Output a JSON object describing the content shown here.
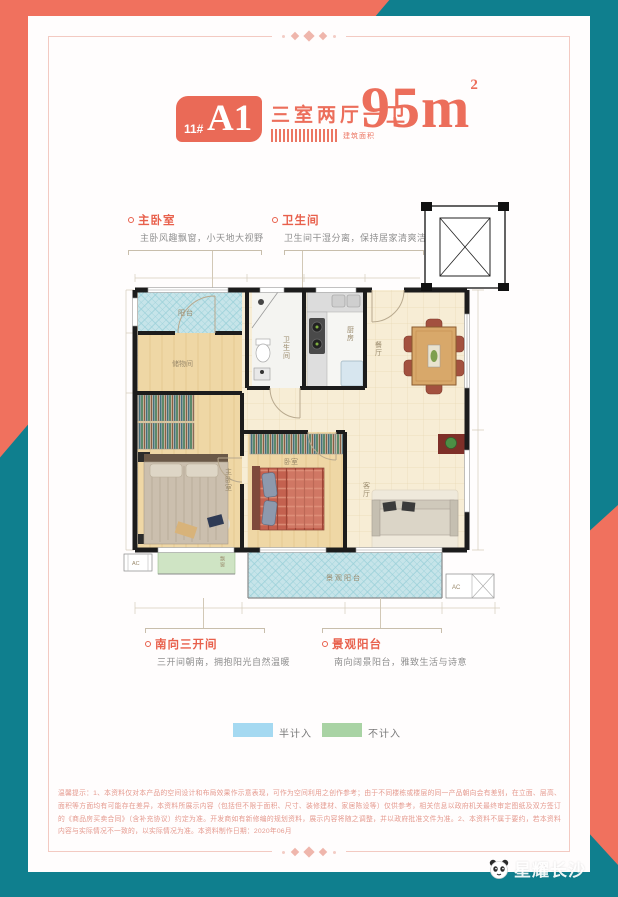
{
  "header": {
    "block_no": "11#",
    "unit": "A1",
    "layout": "三室两厅一卫",
    "area_label": "建筑面积",
    "area_value": "95",
    "area_unit": "m",
    "area_sup": "2"
  },
  "colors": {
    "teal": "#0f7f8e",
    "coral": "#f0715e",
    "badge": "#ea6a57",
    "legend_blue": "#a5d9f1",
    "legend_green": "#a9d3a4"
  },
  "plan": {
    "rooms": {
      "balcony": "阳台",
      "storage": "储物间",
      "bath": "卫生间",
      "kitchen": "厨房",
      "dining": "餐厅",
      "living": "客厅",
      "master": "主卧室",
      "bedroom": "卧室",
      "view_balcony": "景观阳台",
      "bay_window": "飘窗",
      "ac": "AC"
    }
  },
  "annotations": {
    "master": {
      "title": "主卧室",
      "desc": "主卧风趣飘窗，小天地大视野"
    },
    "bath": {
      "title": "卫生间",
      "desc": "卫生间干湿分离，保持居家清爽洁净"
    },
    "south": {
      "title": "南向三开间",
      "desc": "三开间朝南，拥抱阳光自然温暖"
    },
    "view": {
      "title": "景观阳台",
      "desc": "南向阔景阳台，雅致生活与诗意"
    }
  },
  "legend": {
    "half": "半计入",
    "excluded": "不计入"
  },
  "disclaimer": "温馨提示：1、本资料仅对本产品的空间设计和布局效果作示意表现，可作为空间利用之创作参考；由于不同楼栋或楼层的同一产品朝向会有差别，在立面、层高、面积等方面均有可能存在差异，本资料所展示内容（包括但不限于面积、尺寸、装修建材、家居陈设等）仅供参考，相关信息以政府机关最终审定图纸及双方签订的《商品房买卖合同》（含补充协议）约定为准。开发商如有新修编的规划资料，展示内容将随之调整，并以政府批准文件为准。2、本资料不属于要约，若本资料内容与实际情况不一致的，以实际情况为准。本资料制作日期：2020年06月",
  "watermark": "星耀长沙"
}
